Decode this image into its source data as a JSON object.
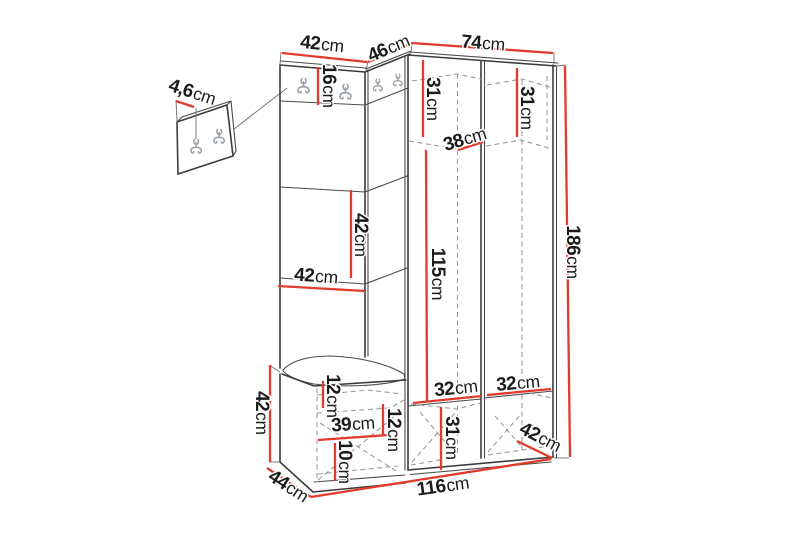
{
  "diagram": {
    "kind": "furniture-dimension-diagram",
    "subject": "corner hallway unit with coat hooks, shelves, bench and wardrobe",
    "background_color": "#ffffff",
    "colors": {
      "dimension_line": "#e23b2e",
      "outline": "#3c3c3c",
      "hidden_line": "#9b9b9b",
      "hook": "#98a0a6",
      "label_text": "#1b1b1b"
    },
    "dimensions": {
      "wall_panel_thickness": {
        "value": "4,6",
        "unit": "cm"
      },
      "left_panel_width": {
        "value": "42",
        "unit": "cm"
      },
      "corner_panel_width": {
        "value": "46",
        "unit": "cm"
      },
      "wardrobe_width": {
        "value": "74",
        "unit": "cm"
      },
      "hook_strip_height": {
        "value": "16",
        "unit": "cm"
      },
      "wardrobe_left_upper_height": {
        "value": "31",
        "unit": "cm"
      },
      "wardrobe_right_upper_height": {
        "value": "31",
        "unit": "cm"
      },
      "wardrobe_upper_depth": {
        "value": "38",
        "unit": "cm"
      },
      "left_shelf_spacing": {
        "value": "42",
        "unit": "cm"
      },
      "left_shelf_width": {
        "value": "42",
        "unit": "cm"
      },
      "hanging_space_height": {
        "value": "115",
        "unit": "cm"
      },
      "total_height": {
        "value": "186",
        "unit": "cm"
      },
      "bench_height": {
        "value": "42",
        "unit": "cm"
      },
      "bench_upper_section_height": {
        "value": "12",
        "unit": "cm"
      },
      "bench_inner_width": {
        "value": "39",
        "unit": "cm"
      },
      "bench_lower_section_height": {
        "value": "10",
        "unit": "cm"
      },
      "bench_right_section_height": {
        "value": "12",
        "unit": "cm"
      },
      "wardrobe_left_lower_width": {
        "value": "32",
        "unit": "cm"
      },
      "wardrobe_right_lower_width": {
        "value": "32",
        "unit": "cm"
      },
      "wardrobe_lower_section_height": {
        "value": "31",
        "unit": "cm"
      },
      "wardrobe_depth": {
        "value": "42",
        "unit": "cm"
      },
      "bench_depth": {
        "value": "44",
        "unit": "cm"
      },
      "total_width": {
        "value": "116",
        "unit": "cm"
      }
    }
  }
}
